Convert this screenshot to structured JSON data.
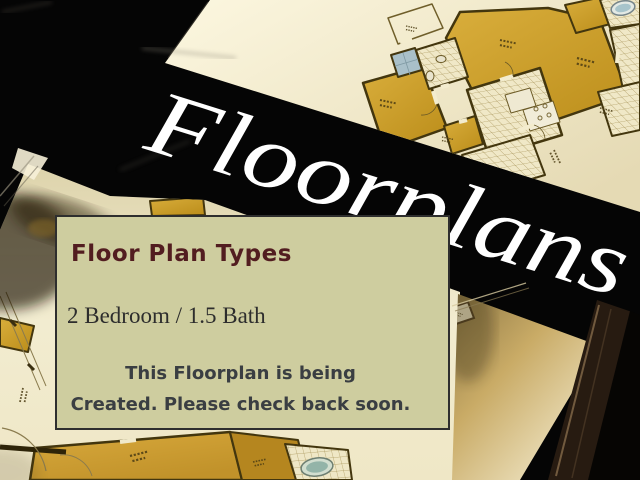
{
  "page": {
    "width": 640,
    "height": 480
  },
  "banner": {
    "title": "Floorplans",
    "text_color": "#ffffff",
    "band_color": "#000000"
  },
  "info_box": {
    "heading": "Floor Plan Types",
    "heading_color": "#521d20",
    "unit_type": "2 Bedroom / 1.5 Bath",
    "unit_type_color": "#2d2d2d",
    "message_line1": "This Floorplan is being",
    "message_line2": "Created. Please check back soon.",
    "message_color": "#3a3e42",
    "background_color": "#cecd9f",
    "border_color": "#2e2e2e"
  },
  "photo_palette": {
    "paper": "#f2ebcd",
    "room_gold": "#cda32f",
    "tile_line": "#a79357",
    "wall": "#43360e",
    "tub_blue": "#a7c4cb",
    "frame_black": "#050505"
  }
}
